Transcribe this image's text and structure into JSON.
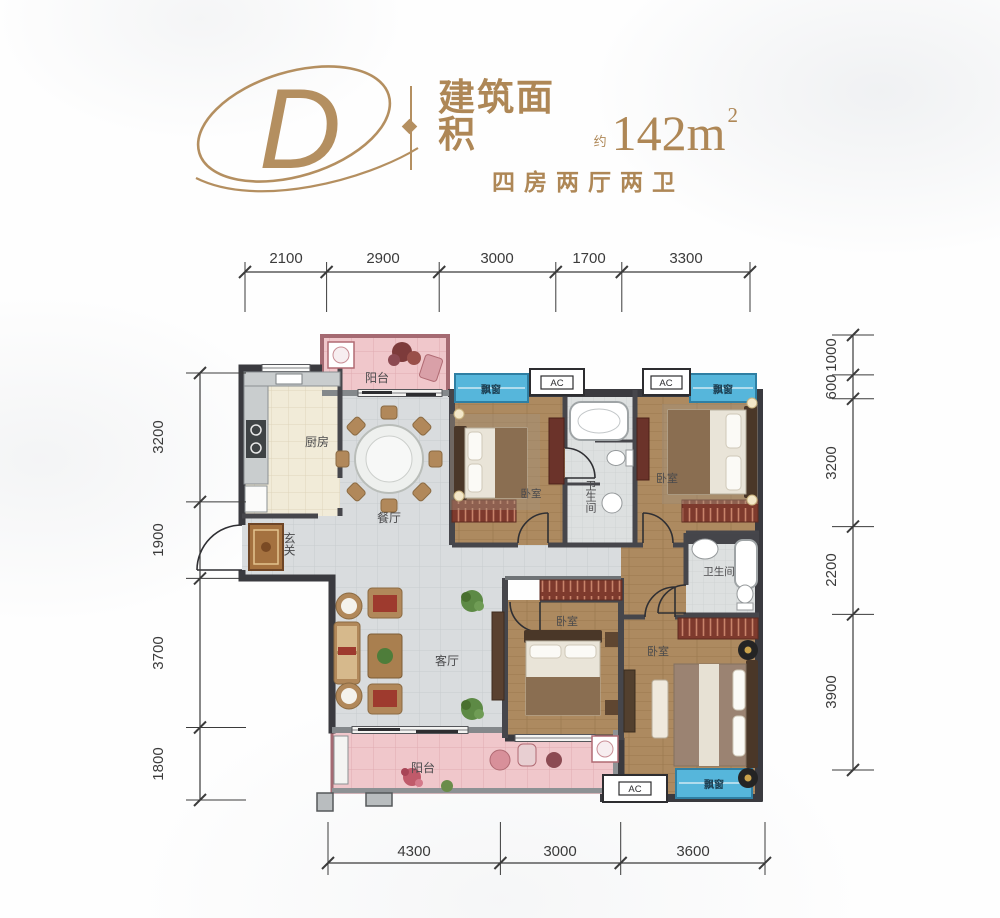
{
  "header": {
    "logo_letter": "D",
    "area_label": "建筑面积",
    "area_approx": "约",
    "area_value": "142m",
    "area_superscript": "2",
    "subtitle": "四房两厅两卫"
  },
  "dimensions": {
    "top": [
      "2100",
      "2900",
      "3000",
      "1700",
      "3300"
    ],
    "left": [
      "3200",
      "1900",
      "3700",
      "1800"
    ],
    "right": [
      "1000",
      "600",
      "3200",
      "2200",
      "3900"
    ],
    "bottom": [
      "4300",
      "3000",
      "3600"
    ]
  },
  "rooms": {
    "balcony_top": "阳台",
    "kitchen": "厨房",
    "dining": "餐厅",
    "entry": "玄关",
    "bedroom_tl": "卧室",
    "bath_mid": "卫生间",
    "bedroom_tr": "卧室",
    "bath_right": "卫生间",
    "living": "客厅",
    "bedroom_mid": "卧室",
    "bedroom_master": "卧室",
    "balcony_bottom": "阳台",
    "bay_tl": "飘窗",
    "bay_tr": "飘窗",
    "bay_bottom": "飘窗",
    "ac_tl": "AC",
    "ac_tr": "AC",
    "ac_bottom": "AC"
  },
  "colors": {
    "brand_gold": "#b48f60",
    "wall_dark": "#3a3a3f",
    "wall_inner": "#46464b",
    "tile_grey": "#d9dcde",
    "kitchen_beige": "#f1ebd8",
    "wood_floor": "#ad8a60",
    "bath_tile": "#dde0e0",
    "balcony_pink": "#f0c7cb",
    "balcony_border": "#a56a72",
    "bay_blue": "#56b6db",
    "wardrobe_red": "#7e3a2d"
  }
}
